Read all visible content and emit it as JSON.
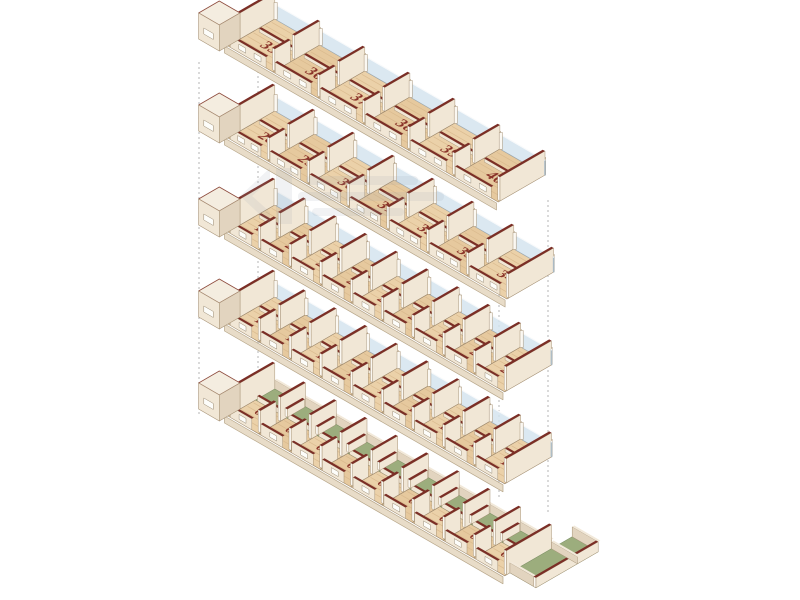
{
  "scene": {
    "type": "isometric-exploded-floor-plan",
    "background": "#ffffff",
    "floor_count": 5,
    "unit_count": 40
  },
  "floors": [
    {
      "id": "level-5",
      "units": [
        "35",
        "36",
        "37",
        "38",
        "39",
        "40"
      ],
      "origin": [
        228,
        46
      ],
      "unit_width": 52,
      "font_size": 16,
      "gardens": false
    },
    {
      "id": "level-4",
      "units": [
        "28",
        "29",
        "30",
        "31",
        "32",
        "33",
        "34"
      ],
      "origin": [
        228,
        138
      ],
      "unit_width": 46,
      "font_size": 15,
      "gardens": false
    },
    {
      "id": "level-3",
      "units": [
        "19",
        "20",
        "21",
        "22",
        "23",
        "24",
        "25",
        "26",
        "27"
      ],
      "origin": [
        228,
        232
      ],
      "unit_width": 35.5,
      "font_size": 12.5,
      "gardens": false
    },
    {
      "id": "level-2",
      "units": [
        "10",
        "11",
        "12",
        "13",
        "14",
        "15",
        "16",
        "17",
        "18"
      ],
      "origin": [
        228,
        324
      ],
      "unit_width": 35.5,
      "font_size": 12.5,
      "gardens": false
    },
    {
      "id": "level-1",
      "units": [
        "01",
        "02",
        "03",
        "04",
        "05",
        "06",
        "07",
        "08",
        "09"
      ],
      "origin": [
        228,
        416
      ],
      "unit_width": 35.5,
      "font_size": 12.5,
      "gardens": true,
      "garden_extension": {
        "length": 30,
        "depth": 78
      }
    }
  ],
  "guide_lines": [
    {
      "x": 199,
      "y1": 62,
      "y2": 415
    },
    {
      "x": 258,
      "y1": 56,
      "y2": 408
    },
    {
      "x": 499,
      "y1": 255,
      "y2": 498
    },
    {
      "x": 548,
      "y1": 200,
      "y2": 512
    }
  ],
  "watermark": {
    "present": true,
    "legible": false
  },
  "palette": {
    "wood": "#ebd1a9",
    "wood_alt": "#e6c99e",
    "wood_grain": "#d8b88c",
    "wood_edge": "#9f8a6e",
    "wall_lit": "#f1e7d6",
    "wall_shade": "#e2d4bf",
    "wall_white": "#fbf8f2",
    "wall_edge": "#a89478",
    "cap_red": "#7b2e26",
    "slab": "#e8dcc8",
    "slab_edge": "#b7a689",
    "glass": "#d4e4ef",
    "glass_frame": "#9db3c5",
    "garden": "#9cad7d",
    "garden_edge": "#80946a",
    "number": "#8a3329",
    "guide": "#b5b5b5",
    "watermark": "#97a0ae"
  }
}
